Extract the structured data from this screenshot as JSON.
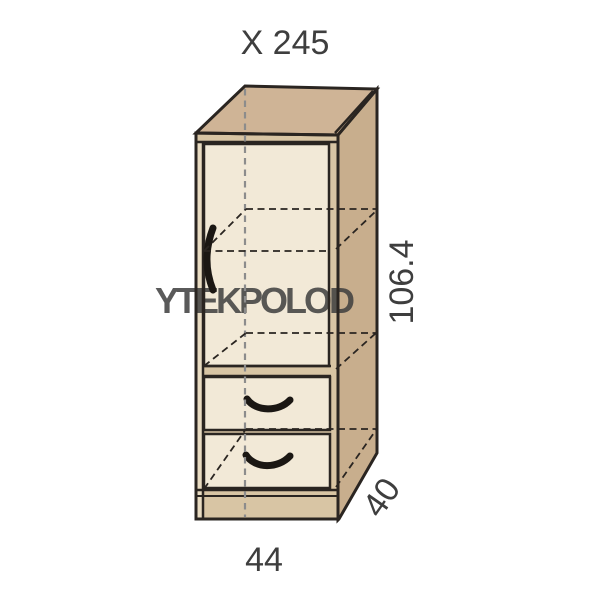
{
  "title": "X 245",
  "watermark_text": "YTEKPOLOD",
  "dimensions": {
    "height_label": "106.4",
    "width_label": "44",
    "depth_label": "40"
  },
  "diagram": {
    "description": "Oblique technical drawing of a tall cabinet module with one hinged door, one internal shelf (hidden dashed), and two lower drawers on a plinth"
  },
  "colors": {
    "background": "#ffffff",
    "wood_top": "#cfb496",
    "wood_side": "#c8ae8d",
    "wood_frame": "#d8c5a4",
    "wood_strip": "#e9dcc2",
    "panel_cream": "#f2e9d7",
    "line": "#2a2521",
    "hidden_line_gray": "#8c8c8c",
    "text": "#3e3e3e",
    "watermark": "#d9d6d2"
  }
}
